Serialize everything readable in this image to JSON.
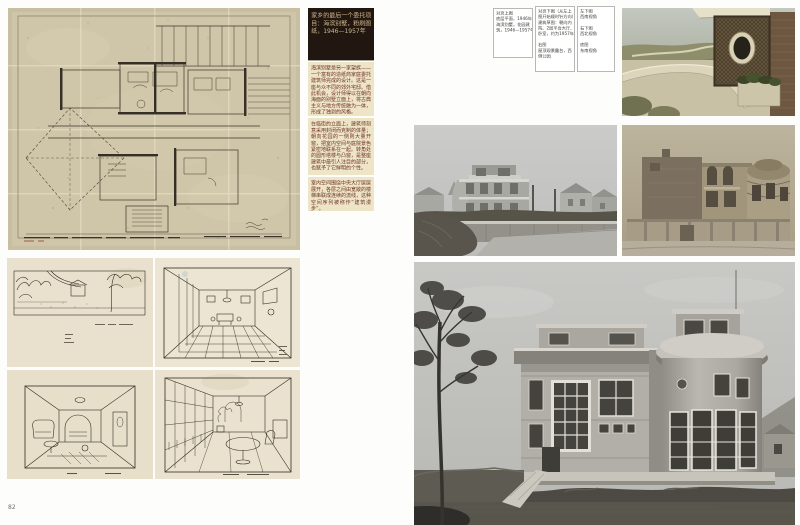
{
  "left_page": {
    "intro_caption": "家乡的最后一个委托项目：海滨别墅，粉刷图纸，1946—1957年",
    "paragraphs": [
      "海滨别墅是另一家望族——一个富有的造纸商家庭委托建筑师完成的设计。这是一座与众不同的郊外宅邸。借此机会，设计师得以在朝向海面的别墅立面上，将古典主义与地方传统融为一体，形成了独到的风格。",
      "在临街的立面上，建筑师刻意采用封闭而克制的体量；朝向花园的一侧则大量开窗，把室内空间与庭院景色紧密地联系在一起。转角处的圆形塔楼与凸窗，是整座建筑中最引人注目的部分，也赋予了它鲜明的个性。",
      "室内空间围绕中央大厅层层展开，各层之间由宽敞的楼梯串联成连续的流线，这种空间序列被称作“建筑漫步”。"
    ],
    "page_number": "82"
  },
  "right_page": {
    "caption_boxes": [
      {
        "text": "对页上图\n底层平面，1946年，\n海滨别墅，花园建\n筑，1946—1957年"
      },
      {
        "text": "对页下图（从左上\n图开始顺时针方向）\n建筑草图：朝向内\n院、2层平台大厅、\n卧室，约为1957年\n\n右图\n屋顶观景露台，西\n侧公园"
      },
      {
        "text": "左下图\n西南视角\n\n右下图\n西北视角\n\n底图\n东南视角"
      }
    ]
  }
}
